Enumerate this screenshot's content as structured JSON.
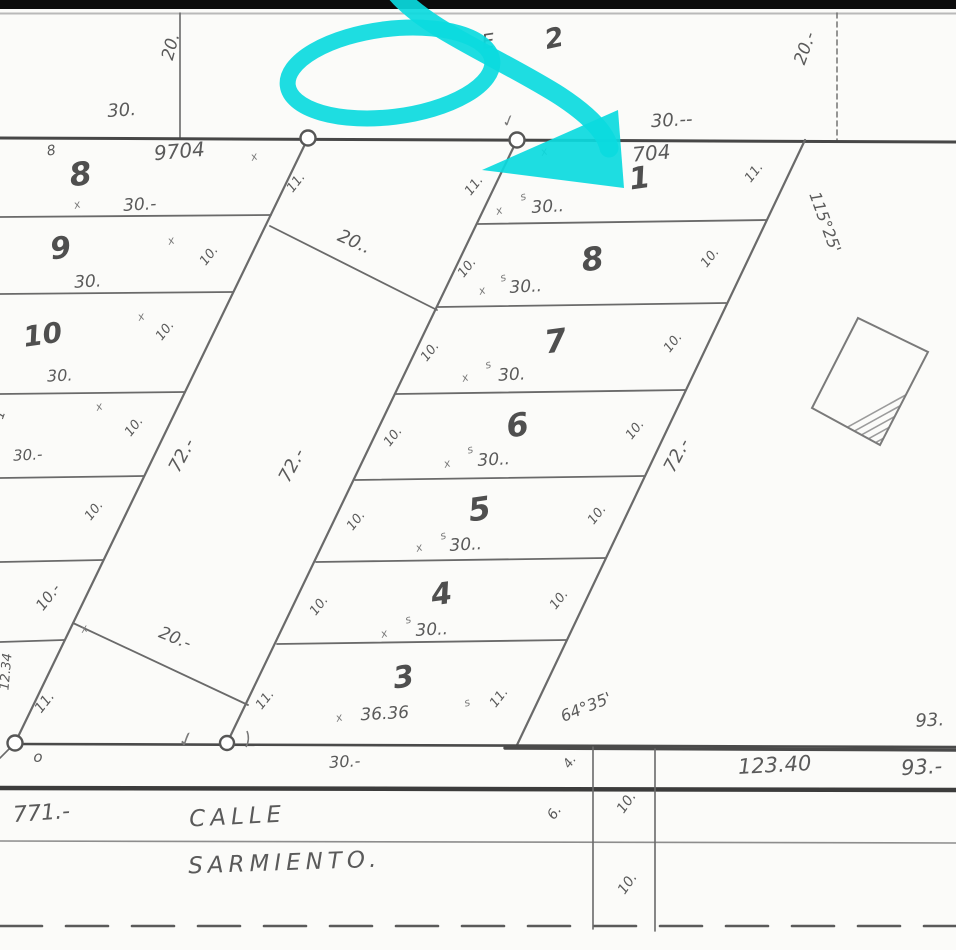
{
  "title_note": "scanned cadastral subdivision plan with cyan highlighter annotation",
  "colors": {
    "paper": "#fbfbf9",
    "ink": "#4f4f4f",
    "ink_soft": "#6a6a6a",
    "ink_light": "#9a9a9a",
    "dark_bar": "#0c0c0c",
    "highlight": "#0bdade"
  },
  "street": {
    "name_line1": "CALLE",
    "name_line2": "SARMIENTO.",
    "left_dimension": "771.-",
    "center_dimension": "123.40",
    "right_dimension": "93.-",
    "upper_right_dimension": "93."
  },
  "map": {
    "top_bar": {
      "h": 9
    },
    "lines": [
      {
        "n": "top-border-line",
        "x1": 0,
        "y1": 13.5,
        "x2": 956,
        "y2": 13.5,
        "w": 2,
        "c": "#b9b9b9"
      },
      {
        "n": "north-vertical-left",
        "x1": 180,
        "y1": 13,
        "x2": 180,
        "y2": 138,
        "w": 1.6
      },
      {
        "n": "north-vertical-right",
        "x1": 837,
        "y1": 13,
        "x2": 837,
        "y2": 141,
        "w": 1.4,
        "dash": "5,4"
      },
      {
        "n": "block-top-boundary",
        "x1": 0,
        "y1": 138,
        "x2": 956,
        "y2": 142,
        "w": 3,
        "c": "#474747"
      },
      {
        "n": "left-column-diagonal",
        "x1": 308,
        "y1": 138,
        "x2": 15,
        "y2": 743,
        "w": 2.2
      },
      {
        "n": "right-column-left-diagonal",
        "x1": 517,
        "y1": 140,
        "x2": 227,
        "y2": 743,
        "w": 2.2
      },
      {
        "n": "right-column-right-diagonal",
        "x1": 805,
        "y1": 140,
        "x2": 517,
        "y2": 745,
        "w": 2.2
      },
      {
        "n": "left-lot-separator",
        "x1": 0,
        "y1": 217,
        "x2": 271,
        "y2": 215,
        "w": 1.8
      },
      {
        "n": "left-lot-separator",
        "x1": 0,
        "y1": 294,
        "x2": 233,
        "y2": 292,
        "w": 1.8
      },
      {
        "n": "left-lot-separator",
        "x1": 0,
        "y1": 394,
        "x2": 185,
        "y2": 392,
        "w": 1.8
      },
      {
        "n": "left-lot-separator",
        "x1": 0,
        "y1": 478,
        "x2": 144,
        "y2": 476,
        "w": 1.8
      },
      {
        "n": "left-lot-separator",
        "x1": 0,
        "y1": 562,
        "x2": 103,
        "y2": 560,
        "w": 1.8
      },
      {
        "n": "left-lot-separator",
        "x1": 0,
        "y1": 642,
        "x2": 64,
        "y2": 640,
        "w": 1.8
      },
      {
        "n": "right-lot-separator",
        "x1": 478,
        "y1": 224,
        "x2": 766,
        "y2": 220,
        "w": 1.8
      },
      {
        "n": "right-lot-separator",
        "x1": 438,
        "y1": 307,
        "x2": 726,
        "y2": 303,
        "w": 1.8
      },
      {
        "n": "right-lot-separator",
        "x1": 396,
        "y1": 394,
        "x2": 685,
        "y2": 390,
        "w": 1.8
      },
      {
        "n": "right-lot-separator",
        "x1": 355,
        "y1": 480,
        "x2": 644,
        "y2": 476,
        "w": 1.8
      },
      {
        "n": "right-lot-separator",
        "x1": 316,
        "y1": 562,
        "x2": 605,
        "y2": 558,
        "w": 1.8
      },
      {
        "n": "right-lot-separator",
        "x1": 277,
        "y1": 644,
        "x2": 566,
        "y2": 640,
        "w": 1.8
      },
      {
        "n": "middle-parcel-top-edge",
        "x1": 270,
        "y1": 226,
        "x2": 437,
        "y2": 310,
        "w": 1.8
      },
      {
        "n": "middle-parcel-bottom-edge",
        "x1": 73,
        "y1": 623,
        "x2": 248,
        "y2": 705,
        "w": 1.8
      },
      {
        "n": "street-north-edge",
        "x1": 15,
        "y1": 744,
        "x2": 956,
        "y2": 747,
        "w": 2.6,
        "c": "#4a4a4a"
      },
      {
        "n": "street-north-edge-thick",
        "x1": 505,
        "y1": 748,
        "x2": 956,
        "y2": 750,
        "w": 3.4,
        "c": "#4a4a4a"
      },
      {
        "n": "street-south-edge",
        "x1": 0,
        "y1": 788,
        "x2": 956,
        "y2": 790,
        "w": 4.5,
        "c": "#3c3c3c"
      },
      {
        "n": "street-mid-line",
        "x1": 0,
        "y1": 841,
        "x2": 956,
        "y2": 843,
        "w": 1.6,
        "c": "#8d8d8d"
      },
      {
        "n": "street-dashed-centerline",
        "x1": 0,
        "y1": 926,
        "x2": 956,
        "y2": 926,
        "w": 2.6,
        "dash": "42,24",
        "c": "#5a5a5a"
      },
      {
        "n": "street-width-tick-line",
        "x1": 593,
        "y1": 747,
        "x2": 593,
        "y2": 929,
        "w": 1.6
      },
      {
        "n": "street-width-tick-line",
        "x1": 655,
        "y1": 749,
        "x2": 655,
        "y2": 931,
        "w": 1.6
      },
      {
        "n": "corner-stub",
        "x1": 15,
        "y1": 743,
        "x2": 0,
        "y2": 758,
        "w": 1.6
      }
    ],
    "monuments": [
      {
        "n": "survey-monument",
        "x": 308,
        "y": 138,
        "r": 7.5
      },
      {
        "n": "survey-monument",
        "x": 517,
        "y": 140,
        "r": 7.5
      },
      {
        "n": "survey-monument",
        "x": 15,
        "y": 743,
        "r": 7.5
      },
      {
        "n": "survey-monument",
        "x": 227,
        "y": 743,
        "r": 7
      }
    ],
    "labels": {
      "top": [
        {
          "t": "20.",
          "x": 176,
          "y": 48,
          "r": -75,
          "s": 17,
          "n": "dim-20-top-left"
        },
        {
          "t": "30.",
          "x": 122,
          "y": 116,
          "r": -4,
          "s": 18,
          "n": "dim-30-top-left"
        },
        {
          "t": "E",
          "x": 489,
          "y": 48,
          "r": -8,
          "s": 20,
          "n": "block-label-partial"
        },
        {
          "t": "2",
          "x": 556,
          "y": 47,
          "r": -12,
          "s": 27,
          "n": "block-label-2",
          "b": 1
        },
        {
          "t": "30.--",
          "x": 672,
          "y": 126,
          "r": -3,
          "s": 18,
          "n": "dim-30-top-right"
        },
        {
          "t": "20.-",
          "x": 810,
          "y": 50,
          "r": -70,
          "s": 17,
          "n": "dim-20-top-right"
        }
      ],
      "left_lots": [
        {
          "t": "8",
          "x": 52,
          "y": 155,
          "r": -10,
          "s": 14,
          "n": "small-mark-8"
        },
        {
          "t": "9704",
          "x": 180,
          "y": 158,
          "r": -5,
          "s": 20,
          "n": "parcel-id-9704"
        },
        {
          "t": "8",
          "x": 82,
          "y": 185,
          "r": -8,
          "s": 32,
          "b": 1,
          "n": "lot-number-8"
        },
        {
          "t": "30.-",
          "x": 140,
          "y": 210,
          "r": -3,
          "s": 17,
          "n": "frontage-30"
        },
        {
          "t": "9",
          "x": 62,
          "y": 258,
          "r": -8,
          "s": 30,
          "b": 1,
          "n": "lot-number-9"
        },
        {
          "t": "30.",
          "x": 88,
          "y": 287,
          "r": -3,
          "s": 17,
          "n": "frontage-30"
        },
        {
          "t": "10",
          "x": 44,
          "y": 344,
          "r": -8,
          "s": 28,
          "b": 1,
          "n": "lot-number-10"
        },
        {
          "t": "30.",
          "x": 60,
          "y": 381,
          "r": -3,
          "s": 16,
          "n": "frontage-30"
        },
        {
          "t": "1",
          "x": 4,
          "y": 416,
          "r": -70,
          "s": 13,
          "n": "partial-lot-number"
        },
        {
          "t": "30.-",
          "x": 28,
          "y": 460,
          "r": -3,
          "s": 15,
          "n": "frontage-30"
        },
        {
          "t": "10.-",
          "x": 52,
          "y": 600,
          "r": -52,
          "s": 15,
          "n": "tick-10"
        },
        {
          "t": "12.34",
          "x": 10,
          "y": 672,
          "r": -85,
          "s": 13,
          "n": "edge-dim-1234"
        },
        {
          "t": "11.",
          "x": 48,
          "y": 705,
          "r": -52,
          "s": 14,
          "n": "tick-11"
        },
        {
          "t": "o",
          "x": 38,
          "y": 762,
          "r": 0,
          "s": 15,
          "n": "point-mark-o"
        },
        {
          "t": "11.",
          "x": 299,
          "y": 185,
          "r": -52,
          "s": 13,
          "n": "tick-11"
        },
        {
          "t": "10.",
          "x": 212,
          "y": 258,
          "r": -52,
          "s": 13,
          "n": "tick-10"
        },
        {
          "t": "10.",
          "x": 168,
          "y": 333,
          "r": -52,
          "s": 13,
          "n": "tick-10"
        },
        {
          "t": "10.",
          "x": 137,
          "y": 429,
          "r": -52,
          "s": 13,
          "n": "tick-10"
        },
        {
          "t": "10.",
          "x": 97,
          "y": 513,
          "r": -52,
          "s": 13,
          "n": "tick-10"
        }
      ],
      "middle_parcel": [
        {
          "t": "20..",
          "x": 352,
          "y": 247,
          "r": 24,
          "s": 18,
          "n": "dim-20-top"
        },
        {
          "t": "72.-",
          "x": 187,
          "y": 458,
          "r": -62,
          "s": 18,
          "n": "dim-72-left"
        },
        {
          "t": "72.-",
          "x": 297,
          "y": 468,
          "r": -62,
          "s": 18,
          "n": "dim-72-right"
        },
        {
          "t": "20.-",
          "x": 173,
          "y": 643,
          "r": 22,
          "s": 17,
          "n": "dim-20-bottom"
        }
      ],
      "right_lots": [
        {
          "t": "704",
          "x": 652,
          "y": 160,
          "r": -5,
          "s": 20,
          "n": "parcel-id-704"
        },
        {
          "t": "1",
          "x": 641,
          "y": 188,
          "r": -8,
          "s": 30,
          "b": 1,
          "n": "lot-number-1"
        },
        {
          "t": "30..",
          "x": 548,
          "y": 212,
          "r": -3,
          "s": 17,
          "n": "frontage-30"
        },
        {
          "t": "8",
          "x": 594,
          "y": 270,
          "r": -8,
          "s": 32,
          "b": 1,
          "n": "lot-number-8"
        },
        {
          "t": "30..",
          "x": 526,
          "y": 292,
          "r": -3,
          "s": 17,
          "n": "frontage-30"
        },
        {
          "t": "7",
          "x": 557,
          "y": 352,
          "r": -8,
          "s": 32,
          "b": 1,
          "n": "lot-number-7"
        },
        {
          "t": "30.",
          "x": 512,
          "y": 380,
          "r": -3,
          "s": 17,
          "n": "frontage-30"
        },
        {
          "t": "6",
          "x": 519,
          "y": 436,
          "r": -8,
          "s": 32,
          "b": 1,
          "n": "lot-number-6"
        },
        {
          "t": "30..",
          "x": 494,
          "y": 465,
          "r": -3,
          "s": 17,
          "n": "frontage-30"
        },
        {
          "t": "5",
          "x": 481,
          "y": 520,
          "r": -8,
          "s": 32,
          "b": 1,
          "n": "lot-number-5"
        },
        {
          "t": "30..",
          "x": 466,
          "y": 550,
          "r": -3,
          "s": 17,
          "n": "frontage-30"
        },
        {
          "t": "4",
          "x": 443,
          "y": 604,
          "r": -8,
          "s": 30,
          "b": 1,
          "n": "lot-number-4"
        },
        {
          "t": "30..",
          "x": 432,
          "y": 635,
          "r": -3,
          "s": 17,
          "n": "frontage-30"
        },
        {
          "t": "3",
          "x": 405,
          "y": 687,
          "r": -8,
          "s": 30,
          "b": 1,
          "n": "lot-number-3"
        },
        {
          "t": "36.36",
          "x": 385,
          "y": 719,
          "r": -3,
          "s": 17,
          "n": "frontage-3636"
        },
        {
          "t": "30.-",
          "x": 345,
          "y": 767,
          "r": -3,
          "s": 16,
          "n": "dim-30-below"
        },
        {
          "t": "11.",
          "x": 477,
          "y": 188,
          "r": -52,
          "s": 13,
          "n": "tick-11"
        },
        {
          "t": "10.",
          "x": 470,
          "y": 270,
          "r": -52,
          "s": 13,
          "n": "tick-10"
        },
        {
          "t": "10.",
          "x": 433,
          "y": 354,
          "r": -52,
          "s": 13,
          "n": "tick-10"
        },
        {
          "t": "10.",
          "x": 396,
          "y": 439,
          "r": -52,
          "s": 13,
          "n": "tick-10"
        },
        {
          "t": "10.",
          "x": 359,
          "y": 523,
          "r": -52,
          "s": 13,
          "n": "tick-10"
        },
        {
          "t": "10.",
          "x": 322,
          "y": 608,
          "r": -52,
          "s": 13,
          "n": "tick-10"
        },
        {
          "t": "11.",
          "x": 268,
          "y": 702,
          "r": -52,
          "s": 13,
          "n": "tick-11"
        },
        {
          "t": "11.",
          "x": 757,
          "y": 175,
          "r": -52,
          "s": 13,
          "n": "tick-11"
        },
        {
          "t": "10.",
          "x": 713,
          "y": 260,
          "r": -52,
          "s": 13,
          "n": "tick-10"
        },
        {
          "t": "10.",
          "x": 676,
          "y": 345,
          "r": -52,
          "s": 13,
          "n": "tick-10"
        },
        {
          "t": "10.",
          "x": 638,
          "y": 432,
          "r": -52,
          "s": 13,
          "n": "tick-10"
        },
        {
          "t": "10.",
          "x": 600,
          "y": 517,
          "r": -52,
          "s": 13,
          "n": "tick-10"
        },
        {
          "t": "10.",
          "x": 562,
          "y": 602,
          "r": -52,
          "s": 13,
          "n": "tick-10"
        },
        {
          "t": "11.",
          "x": 502,
          "y": 700,
          "r": -52,
          "s": 13,
          "n": "tick-11"
        },
        {
          "t": "72.-",
          "x": 682,
          "y": 458,
          "r": -62,
          "s": 18,
          "n": "dim-72-right-column"
        },
        {
          "t": "115°25'",
          "x": 820,
          "y": 224,
          "r": 70,
          "s": 16,
          "n": "angle-115-25"
        },
        {
          "t": "64°35'",
          "x": 588,
          "y": 712,
          "r": -22,
          "s": 16,
          "n": "angle-64-35"
        }
      ],
      "street": [
        {
          "t": "93.",
          "x": 930,
          "y": 726,
          "r": -3,
          "s": 18,
          "n": "dim-93-upper"
        },
        {
          "t": "123.40",
          "x": 775,
          "y": 772,
          "r": -3,
          "s": 21,
          "n": "dim-123-40"
        },
        {
          "t": "93.-",
          "x": 922,
          "y": 774,
          "r": -3,
          "s": 21,
          "n": "dim-93"
        },
        {
          "t": "771.-",
          "x": 42,
          "y": 820,
          "r": -4,
          "s": 22,
          "n": "dim-771"
        },
        {
          "t": "CALLE",
          "x": 238,
          "y": 824,
          "r": -3,
          "s": 23,
          "ls": 5,
          "n": "street-name-calle"
        },
        {
          "t": "SARMIENTO.",
          "x": 285,
          "y": 870,
          "r": -2,
          "s": 23,
          "ls": 5,
          "n": "street-name-sarmiento"
        },
        {
          "t": "4.",
          "x": 573,
          "y": 764,
          "r": -55,
          "s": 13,
          "n": "tick-4"
        },
        {
          "t": "6.",
          "x": 558,
          "y": 815,
          "r": -55,
          "s": 14,
          "n": "tick-6"
        },
        {
          "t": "10.",
          "x": 630,
          "y": 805,
          "r": -55,
          "s": 14,
          "n": "tick-10"
        },
        {
          "t": "10.",
          "x": 631,
          "y": 886,
          "r": -55,
          "s": 14,
          "n": "tick-10"
        }
      ]
    },
    "marks": [
      {
        "t": "x",
        "x": 78,
        "y": 208
      },
      {
        "t": "x",
        "x": 255,
        "y": 160
      },
      {
        "t": "x",
        "x": 172,
        "y": 244
      },
      {
        "t": "x",
        "x": 142,
        "y": 320
      },
      {
        "t": "x",
        "x": 100,
        "y": 410
      },
      {
        "t": "x",
        "x": 85,
        "y": 632
      },
      {
        "t": "x",
        "x": 500,
        "y": 214
      },
      {
        "t": "x",
        "x": 483,
        "y": 294
      },
      {
        "t": "x",
        "x": 466,
        "y": 381
      },
      {
        "t": "x",
        "x": 448,
        "y": 467
      },
      {
        "t": "x",
        "x": 420,
        "y": 551
      },
      {
        "t": "x",
        "x": 385,
        "y": 637
      },
      {
        "t": "x",
        "x": 340,
        "y": 721
      },
      {
        "t": "x",
        "x": 545,
        "y": 155
      },
      {
        "t": "s",
        "x": 524,
        "y": 200
      },
      {
        "t": "s",
        "x": 504,
        "y": 281
      },
      {
        "t": "s",
        "x": 489,
        "y": 368
      },
      {
        "t": "s",
        "x": 471,
        "y": 453
      },
      {
        "t": "s",
        "x": 444,
        "y": 539
      },
      {
        "t": "s",
        "x": 409,
        "y": 623
      },
      {
        "t": "s",
        "x": 468,
        "y": 706
      },
      {
        "t": "✓",
        "x": 510,
        "y": 126,
        "s": 16
      },
      {
        "t": "✓",
        "x": 188,
        "y": 746,
        "s": 20
      }
    ],
    "hatch_box": {
      "n": "hatched-reference-square",
      "points": "858,318 928,352 880,445 812,408",
      "hatch_step": 14
    },
    "highlight": {
      "ellipse": {
        "n": "highlight-ellipse",
        "cx": 390,
        "cy": 73,
        "rx": 103,
        "ry": 44,
        "rot": -7,
        "sw": 16
      },
      "arrow_shaft": {
        "n": "highlight-arrow-shaft",
        "d": "M 397,-6 C 428,30 500,58 560,96 C 592,117 606,134 609,148",
        "sw": 19
      },
      "arrow_head": {
        "n": "highlight-arrow-head",
        "points": "618,110 624,188 482,170"
      }
    }
  }
}
